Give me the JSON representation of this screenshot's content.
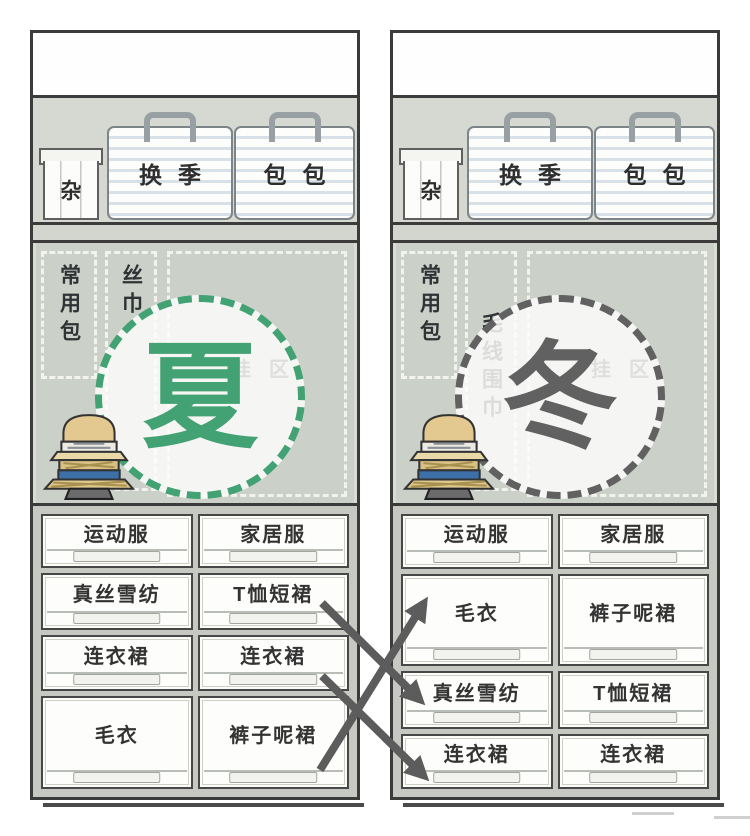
{
  "colors": {
    "summer_accent": "#43a273",
    "winter_accent": "#616161",
    "arrow": "#5c5c5c"
  },
  "closets": [
    {
      "season": "summer",
      "season_label": "夏",
      "accent": "#43a273",
      "top_shelf": {
        "misc_box_label": "杂",
        "seasonal_box_label": "换季",
        "bags_box_label": "包包"
      },
      "hanging_section": {
        "frequent_bags_label": "常用包",
        "scarf_label": "丝巾",
        "hanging_zone_label": "挂区"
      },
      "drawers": [
        [
          "运动服",
          "家居服"
        ],
        [
          "真丝雪纺",
          "T恤短裙"
        ],
        [
          "连衣裙",
          "连衣裙"
        ],
        [
          "毛衣",
          "裤子呢裙"
        ]
      ]
    },
    {
      "season": "winter",
      "season_label": "冬",
      "accent": "#616161",
      "top_shelf": {
        "misc_box_label": "杂",
        "seasonal_box_label": "换季",
        "bags_box_label": "包包"
      },
      "hanging_section": {
        "frequent_bags_label": "常用包",
        "scarf_label": "毛线围巾",
        "hanging_zone_label": "挂区"
      },
      "drawers": [
        [
          "运动服",
          "家居服"
        ],
        [
          "毛衣",
          "裤子呢裙"
        ],
        [
          "真丝雪纺",
          "T恤短裙"
        ],
        [
          "连衣裙",
          "连衣裙"
        ]
      ]
    }
  ],
  "arrows": [
    {
      "x1": 322,
      "y1": 603,
      "x2": 420,
      "y2": 700
    },
    {
      "x1": 322,
      "y1": 676,
      "x2": 424,
      "y2": 776
    },
    {
      "x1": 320,
      "y1": 770,
      "x2": 424,
      "y2": 603
    }
  ]
}
